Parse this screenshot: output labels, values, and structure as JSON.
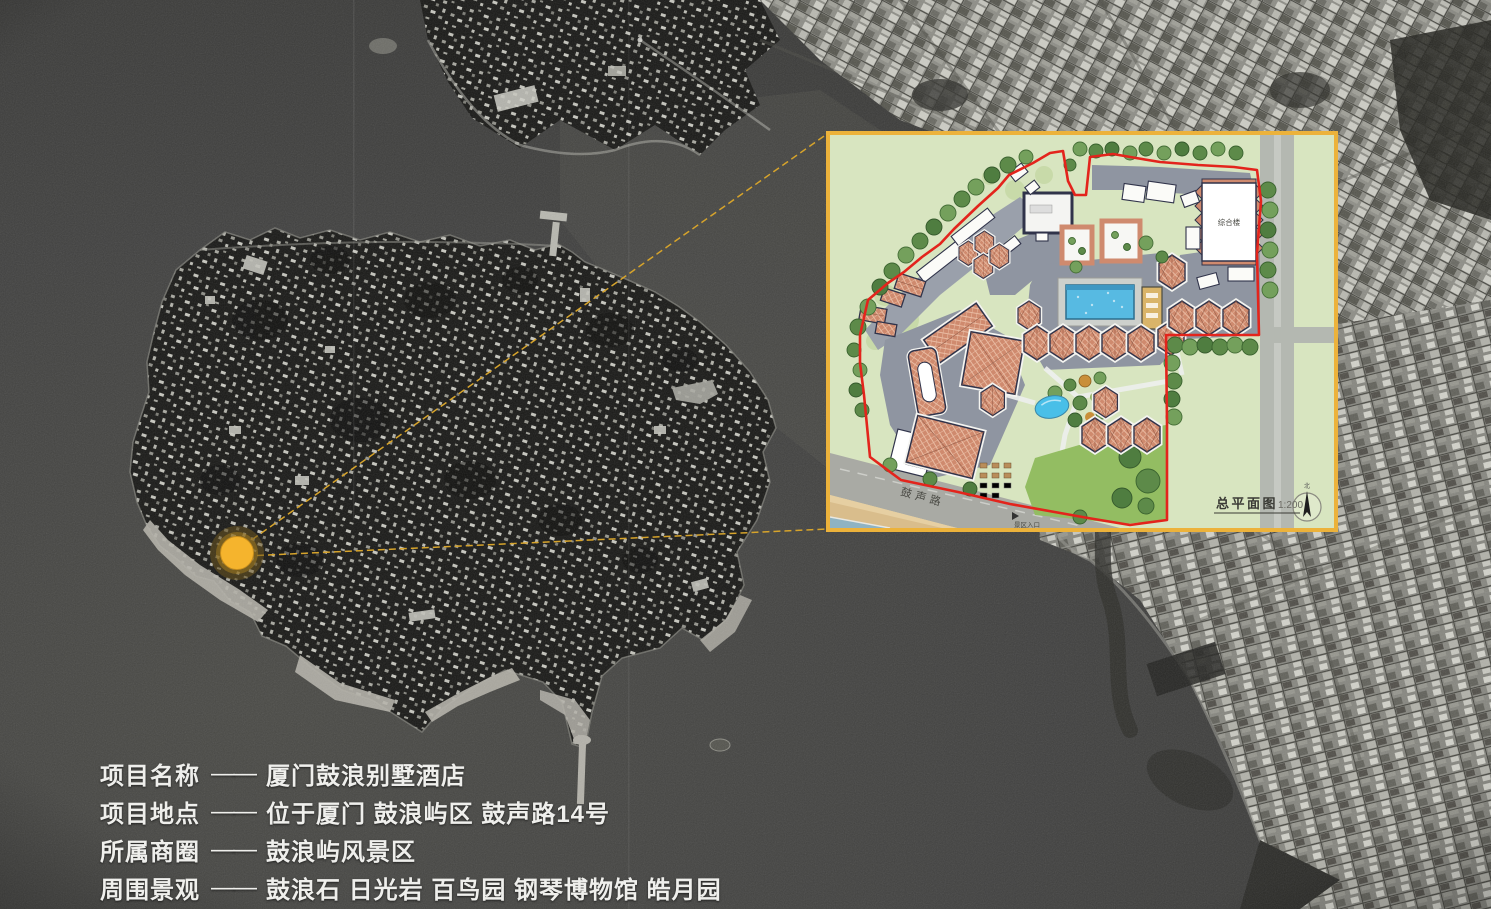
{
  "project_info": {
    "rows": [
      {
        "label": "项目名称",
        "dash": "——",
        "value": "厦门鼓浪别墅酒店"
      },
      {
        "label": "项目地点",
        "dash": "——",
        "value": "位于厦门 鼓浪屿区 鼓声路14号"
      },
      {
        "label": "所属商圈",
        "dash": "——",
        "value": "鼓浪屿风景区"
      },
      {
        "label": "周围景观",
        "dash": "——",
        "value": "鼓浪石 日光岩 百鸟园 钢琴博物馆 皓月园"
      }
    ]
  },
  "site_plan": {
    "title": "总平面图",
    "scale": "1:200",
    "road_label": "鼓声路",
    "entrance_label": "景区入口",
    "main_building_label": "综合楼",
    "north_label": "北",
    "frame_color": "#ECB23B",
    "boundary_color": "#E3241C",
    "lawn_color": "#93BD62",
    "pool_color": "#57BAE2",
    "roof_color": "#CF8A6E"
  },
  "map": {
    "marker_color": "#F5B42D",
    "callout_line_color": "#D7A42B",
    "water_color": "#3D3D3A"
  }
}
